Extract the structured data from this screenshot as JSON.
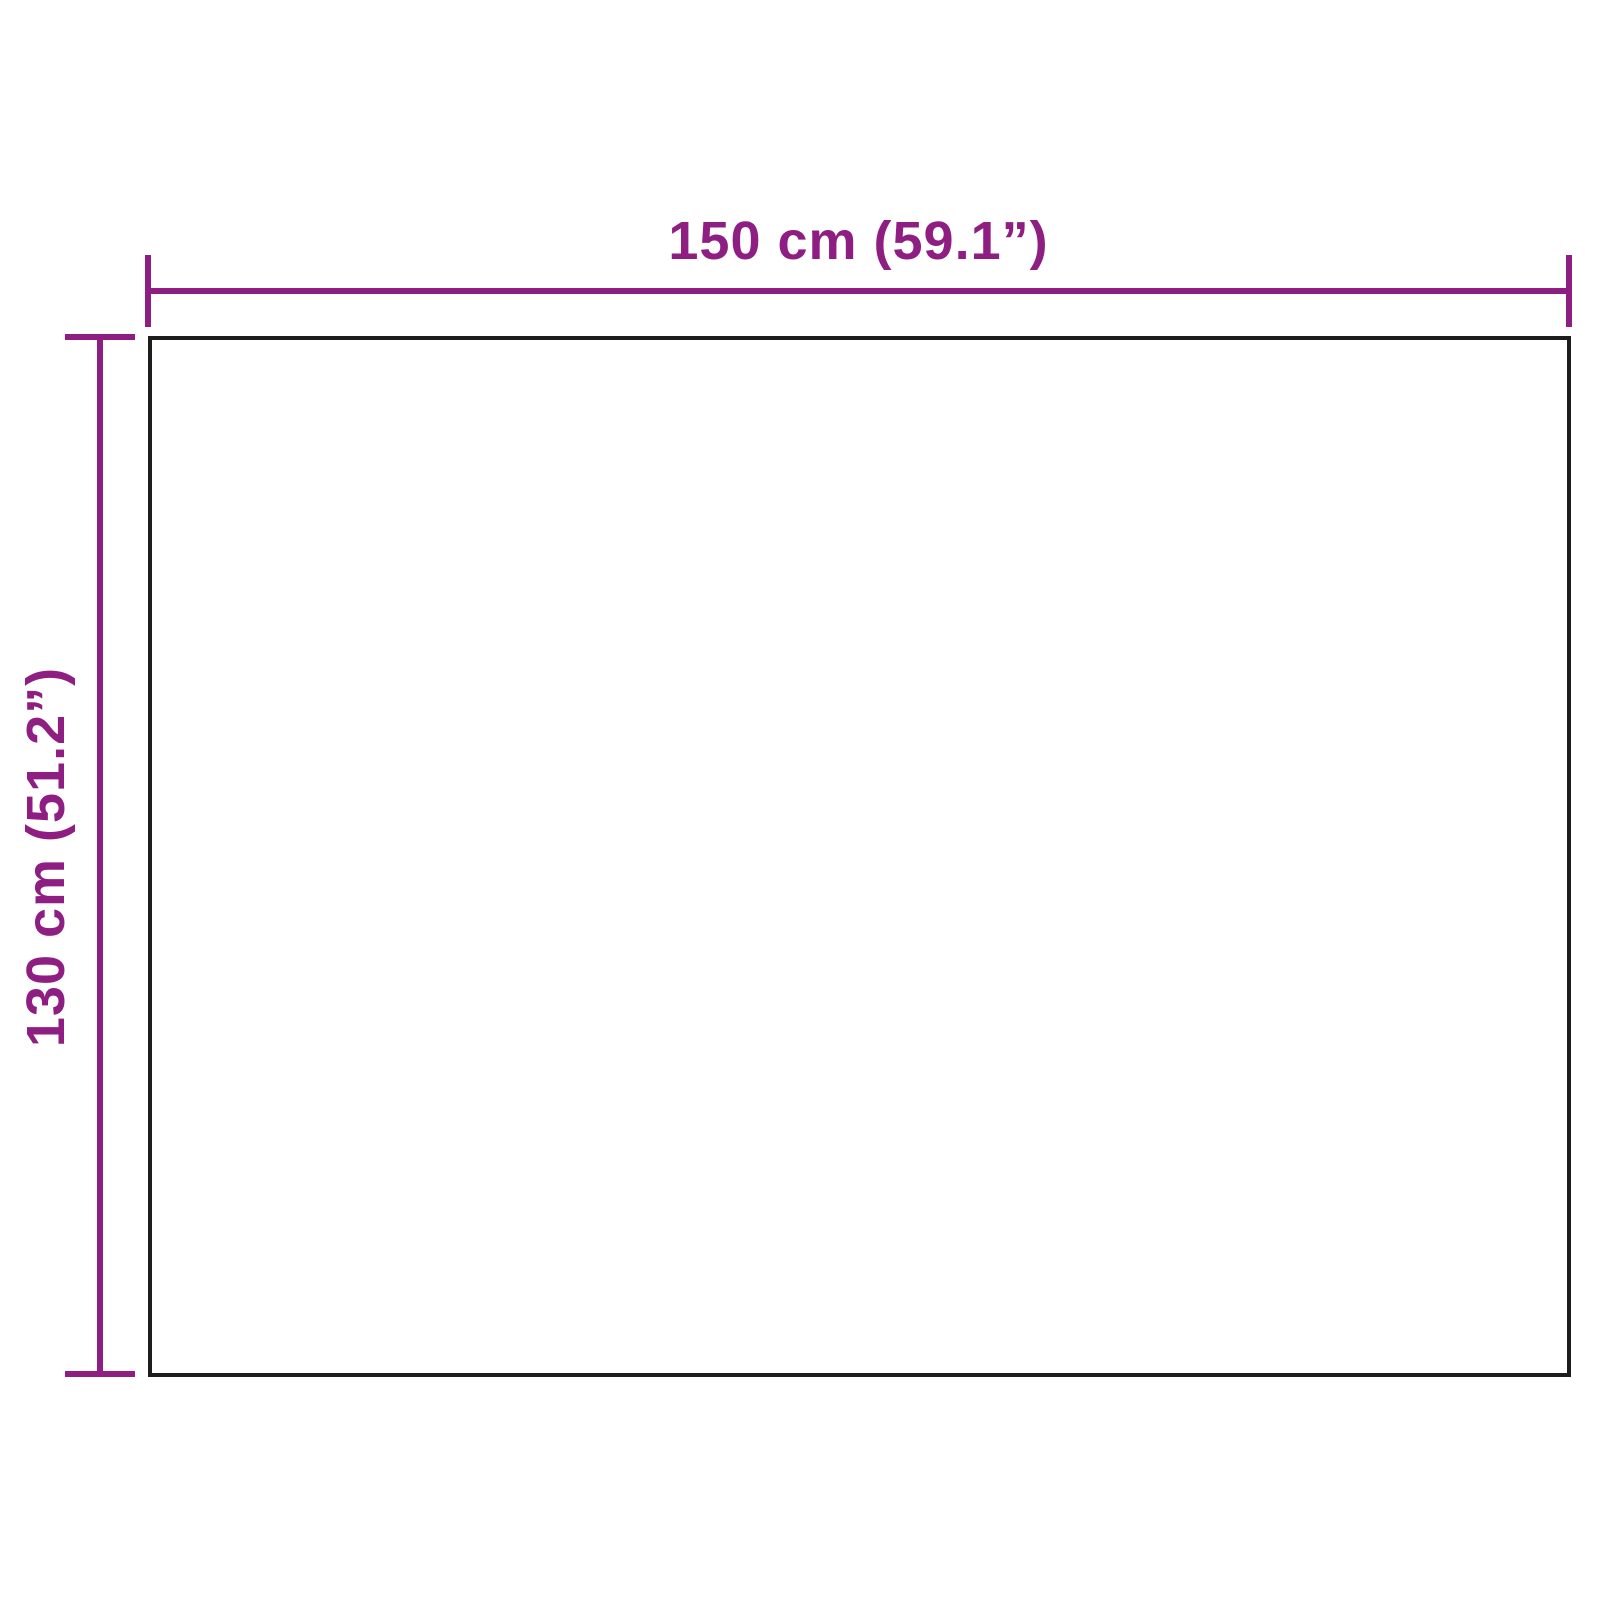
{
  "diagram": {
    "kind": "product-dimension-diagram",
    "shape": "rectangle",
    "width_dimension": {
      "label": "150 cm (59.1”)",
      "value_cm": 150,
      "value_inches": 59.1
    },
    "height_dimension": {
      "label": "130 cm (51.2”)",
      "value_cm": 130,
      "value_inches": 51.2
    },
    "colors": {
      "dimension_lines": "#8e1e82",
      "product_outline": "#1d1d1b",
      "background": "#ffffff"
    }
  }
}
